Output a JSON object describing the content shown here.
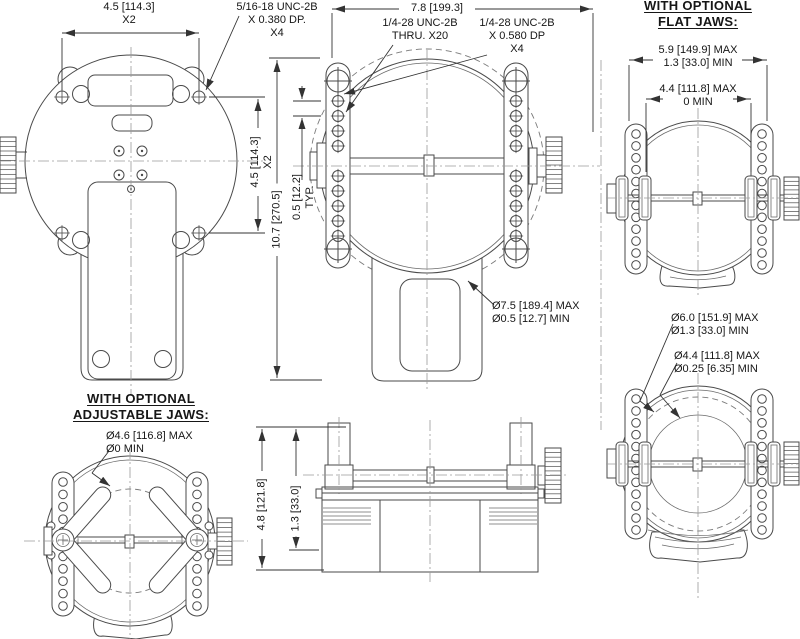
{
  "drawing": {
    "labels": {
      "dim_4_5_top": {
        "line1": "4.5 [114.3]",
        "line2": "X2"
      },
      "note_5_16": {
        "line1": "5/16-18 UNC-2B",
        "line2": "X 0.380 DP.",
        "line3": "X4"
      },
      "dim_7_8": {
        "line1": "7.8 [199.3]"
      },
      "note_thru": {
        "line1": "1/4-28 UNC-2B",
        "line2": "THRU. X20"
      },
      "note_0580": {
        "line1": "1/4-28 UNC-2B",
        "line2": "X 0.580 DP",
        "line3": "X4"
      },
      "dim_4_5_side": {
        "line1": "4.5 [114.3]",
        "line2": "X2"
      },
      "dim_10_7": {
        "line1": "10.7 [270.5]"
      },
      "dim_0_5_typ": {
        "line1": "0.5 [12.2]",
        "line2": "TYP."
      },
      "dia_7_5": {
        "line1": "Ø7.5 [189.4] MAX",
        "line2": "Ø0.5 [12.7] MIN"
      },
      "heading_flat": {
        "line1": "WITH OPTIONAL",
        "line2": "FLAT JAWS:"
      },
      "dim_5_9": {
        "line1": "5.9 [149.9] MAX",
        "line2": "1.3 [33.0] MIN"
      },
      "dim_4_4_flat": {
        "line1": "4.4 [111.8] MAX",
        "line2": "0 MIN"
      },
      "dia_6_0": {
        "line1": "Ø6.0 [151.9] MAX",
        "line2": "Ø1.3 [33.0] MIN"
      },
      "dia_4_4": {
        "line1": "Ø4.4 [111.8] MAX",
        "line2": "Ø0.25 [6.35] MIN"
      },
      "heading_adj": {
        "line1": "WITH OPTIONAL",
        "line2": "ADJUSTABLE JAWS:"
      },
      "dia_4_6": {
        "line1": "Ø4.6 [116.8] MAX",
        "line2": "Ø0 MIN"
      },
      "dim_4_8": {
        "line1": "4.8 [121.8]"
      },
      "dim_1_3": {
        "line1": "1.3 [33.0]"
      }
    },
    "colors": {
      "line": "#4a4a4a",
      "dimension": "#333333",
      "background": "#ffffff"
    }
  }
}
